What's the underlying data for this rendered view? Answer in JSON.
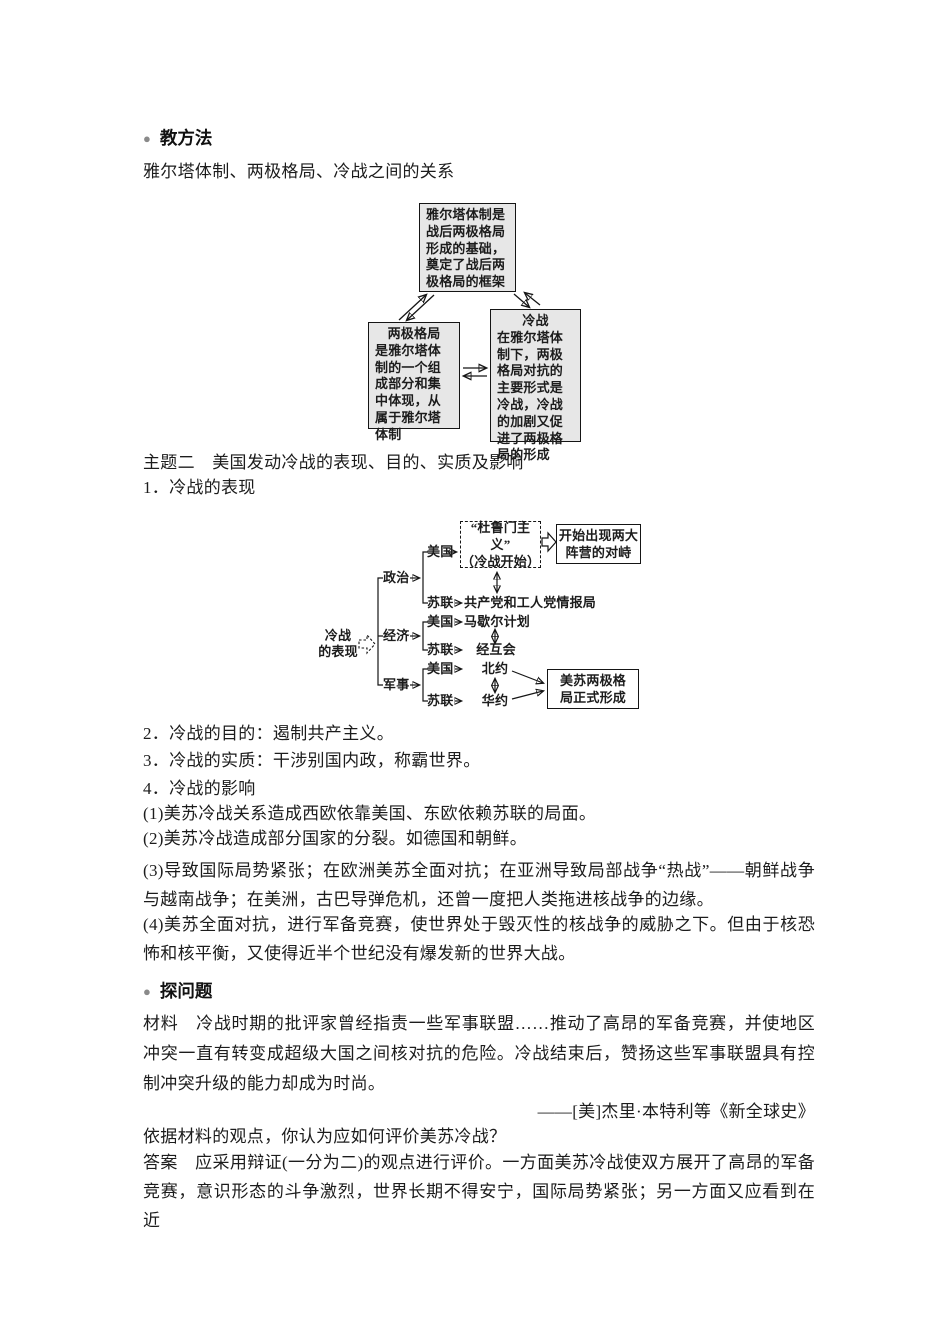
{
  "colors": {
    "bullet": "#8a8a8a",
    "box_fill": "#e7e7e7",
    "line": "#151515"
  },
  "icons": {
    "bullet_glyph": "●"
  },
  "sections": {
    "method_heading": "教方法",
    "relation_line": "雅尔塔体制、两极格局、冷战之间的关系",
    "topic2": "主题二　美国发动冷战的表现、目的、实质及影响",
    "item1": "1．冷战的表现",
    "item2": "2．冷战的目的：遏制共产主义。",
    "item3": "3．冷战的实质：干涉别国内政，称霸世界。",
    "item4": "4．冷战的影响",
    "effect1": "(1)美苏冷战关系造成西欧依靠美国、东欧依赖苏联的局面。",
    "effect2": "(2)美苏冷战造成部分国家的分裂。如德国和朝鲜。",
    "effect3": "(3)导致国际局势紧张；在欧洲美苏全面对抗；在亚洲导致局部战争“热战”——朝鲜战争与越南战争；在美洲，古巴导弹危机，还曾一度把人类拖进核战争的边缘。",
    "effect4": "(4)美苏全面对抗，进行军备竞赛，使世界处于毁灭性的核战争的威胁之下。但由于核恐怖和核平衡，又使得近半个世纪没有爆发新的世界大战。",
    "explore_heading": "探问题",
    "material": "材料　冷战时期的批评家曾经指责一些军事联盟……推动了高昂的军备竞赛，并使地区冲突一直有转变成超级大国之间核对抗的危险。冷战结束后，赞扬这些军事联盟具有控制冲突升级的能力却成为时尚。",
    "attribution": "——[美]杰里·本特利等《新全球史》",
    "question": "依据材料的观点，你认为应如何评价美苏冷战？",
    "answer": "答案　应采用辩证(一分为二)的观点进行评价。一方面美苏冷战使双方展开了高昂的军备竞赛，意识形态的斗争激烈，世界长期不得安宁，国际局势紧张；另一方面又应看到在近"
  },
  "diagram1": {
    "top_box": "雅尔塔体制是战后两极格局形成的基础，奠定了战后两极格局的框架",
    "left_box_title": "两极格局",
    "left_box_body": "是雅尔塔体制的一个组成部分和集中体现，从属于雅尔塔体制",
    "right_box_title": "冷战",
    "right_box_body": "在雅尔塔体制下，两极格局对抗的主要形式是冷战，冷战的加剧又促进了两极格局的形成"
  },
  "flowchart": {
    "root_label": "冷战\n的表现",
    "branches": [
      {
        "label": "政治",
        "us_label": "美国",
        "ussr_label": "苏联"
      },
      {
        "label": "经济",
        "us_label": "美国",
        "ussr_label": "苏联"
      },
      {
        "label": "军事",
        "us_label": "美国",
        "ussr_label": "苏联"
      }
    ],
    "truman_box": "“杜鲁门主义”\n（冷战开始）",
    "result_box1": "开始出现两大\n阵营的对峙",
    "cominform": "共产党和工人党情报局",
    "marshall": "马歇尔计划",
    "comecon": "经互会",
    "nato": "北约",
    "warsaw": "华约",
    "result_box2": "美苏两极格\n局正式形成"
  }
}
